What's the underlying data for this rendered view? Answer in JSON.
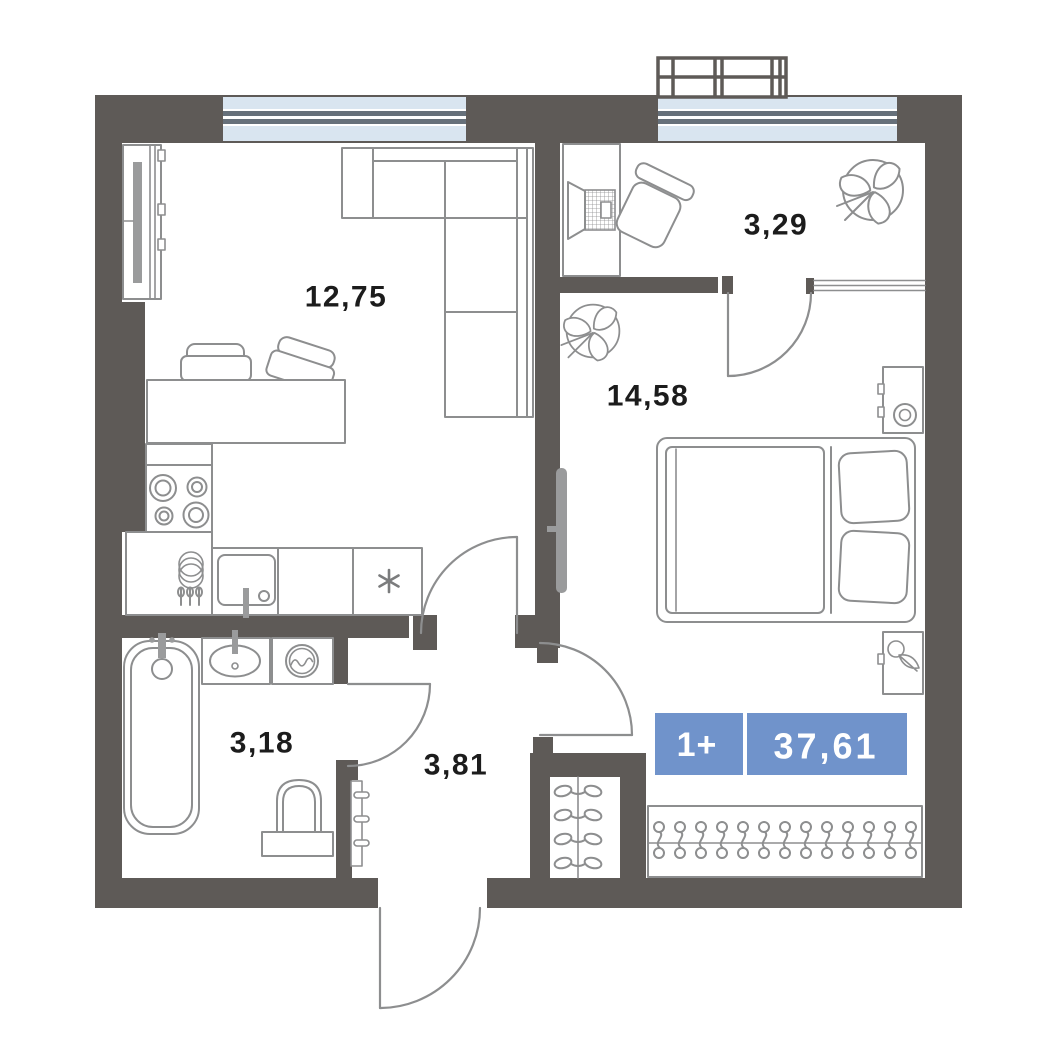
{
  "plan": {
    "badge": {
      "rooms_label": "1+",
      "total_area": "37,61"
    },
    "rooms": {
      "living_kitchen": {
        "area": "12,75"
      },
      "balcony": {
        "area": "3,29"
      },
      "bedroom": {
        "area": "14,58"
      },
      "bathroom": {
        "area": "3,18"
      },
      "hallway": {
        "area": "3,81"
      }
    },
    "symbols": [
      "plant-icon",
      "stove-burners-icon",
      "kitchen-sink-icon",
      "fridge-snowflake-icon",
      "dish-rack-icon",
      "bathtub-icon",
      "washbasin-icon",
      "washing-machine-icon",
      "toilet-icon",
      "towel-hooks-icon",
      "hanger-rail-icon",
      "laptop-icon",
      "bed-icon",
      "lamp-icon",
      "balcony-railing-icon",
      "door-swing-arc",
      "window-glazing"
    ],
    "colors": {
      "wall": "#5e5a57",
      "furniture": "#8d8e8f",
      "glass": "#d9e5f0",
      "glass_frame": "#66707a",
      "badge": "#7093cb",
      "badge_text": "#ffffff",
      "label": "#1c1c1c",
      "radiator": "#9a9b9c"
    }
  }
}
